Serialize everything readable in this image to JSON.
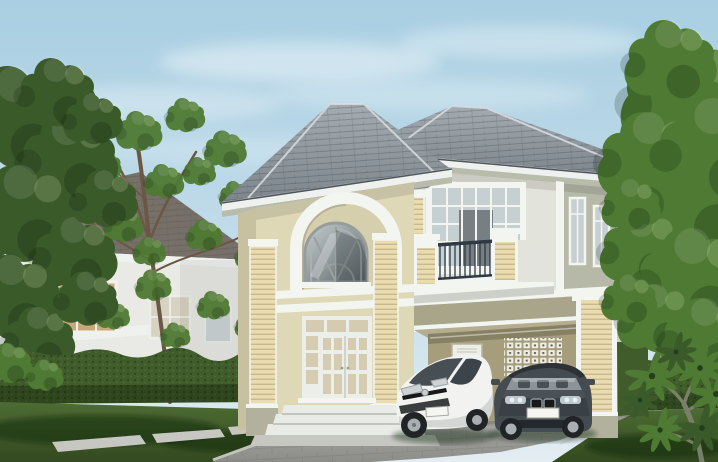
{
  "scene": {
    "type": "architectural-rendering",
    "description": "3D exterior rendering of a two-story cream house with tall arched entry portico, second-floor balcony with dark iron railing, and a carport sheltering a white hatchback and a dark grey sedan; surrounded by lawn, trimmed hedges and leafy trees under a pale blue sky, with a second white house in the left background",
    "objects": [
      "main house",
      "arched portico",
      "balcony",
      "carport",
      "white hatchback car",
      "dark grey sedan",
      "entry door",
      "front steps",
      "driveway",
      "walkway slabs",
      "hedges",
      "lawn",
      "trees",
      "plumeria shrub",
      "background house",
      "sky with clouds"
    ]
  },
  "colors": {
    "sky_top": "#a9cfe2",
    "sky_mid": "#c3dcea",
    "sky_bottom": "#e3edf2",
    "cloud": "#ffffff",
    "roof_light": "#a4acb2",
    "roof_dark": "#7b838a",
    "roof_gutter": "#4f575d",
    "roof_ridge": "#d8dde1",
    "fascia_white": "#eef1ee",
    "eave_sage": "#b9bcaa",
    "wall_cream": "#ded8b7",
    "wall_cream_dark": "#c7c1a0",
    "wall_inner_cream": "#d6cfae",
    "wing_wall": "#e2e3da",
    "side_wall": "#b6b9a8",
    "trim_white": "#f3f5f1",
    "pilaster_cream": "#e9dcb0",
    "pilaster_stripe": "#c9b98c",
    "olive_band": "#a9a58a",
    "plinth": "#b2b19d",
    "carport_wall": "#a59d7b",
    "carport_ceiling": "#b5ad8f",
    "vent_block": "#eceee8",
    "vent_hole": "#655f47",
    "door_white": "#eceeea",
    "glass_warm": "#d5cbb0",
    "glass_light": "#c6cfd2",
    "glass_dark": "#5c6468",
    "window_frame": "#979d9b",
    "railing": "#2f3a45",
    "steps": "#e9ebe6",
    "driveway_light": "#b3b3af",
    "driveway_dark": "#8c8c88",
    "curb": "#d2d2cc",
    "walkway": "#c6c7c1",
    "lawn": "#4d6c33",
    "lawn_dark": "#33491f",
    "lawn_light": "#618343",
    "hedge": "#3f5c2a",
    "hedge_dark": "#2b411a",
    "tree_dark": "#3a5a2a",
    "tree_mid": "#4f7a33",
    "tree_light": "#6f9e4a",
    "branch": "#6b5743",
    "bg_wall": "#e9eae5",
    "bg_roof": "#767069",
    "bg_window": "#c8a878",
    "car_white": "#f2f3f1",
    "car_white_shade": "#c6c9c6",
    "car_dark": "#454c51",
    "car_dark_roof": "#2c3236",
    "tire": "#202427",
    "rim": "#a8aeb1",
    "plate": "#f5f6f2",
    "shadow": "rgba(15,22,12,0.40)"
  }
}
